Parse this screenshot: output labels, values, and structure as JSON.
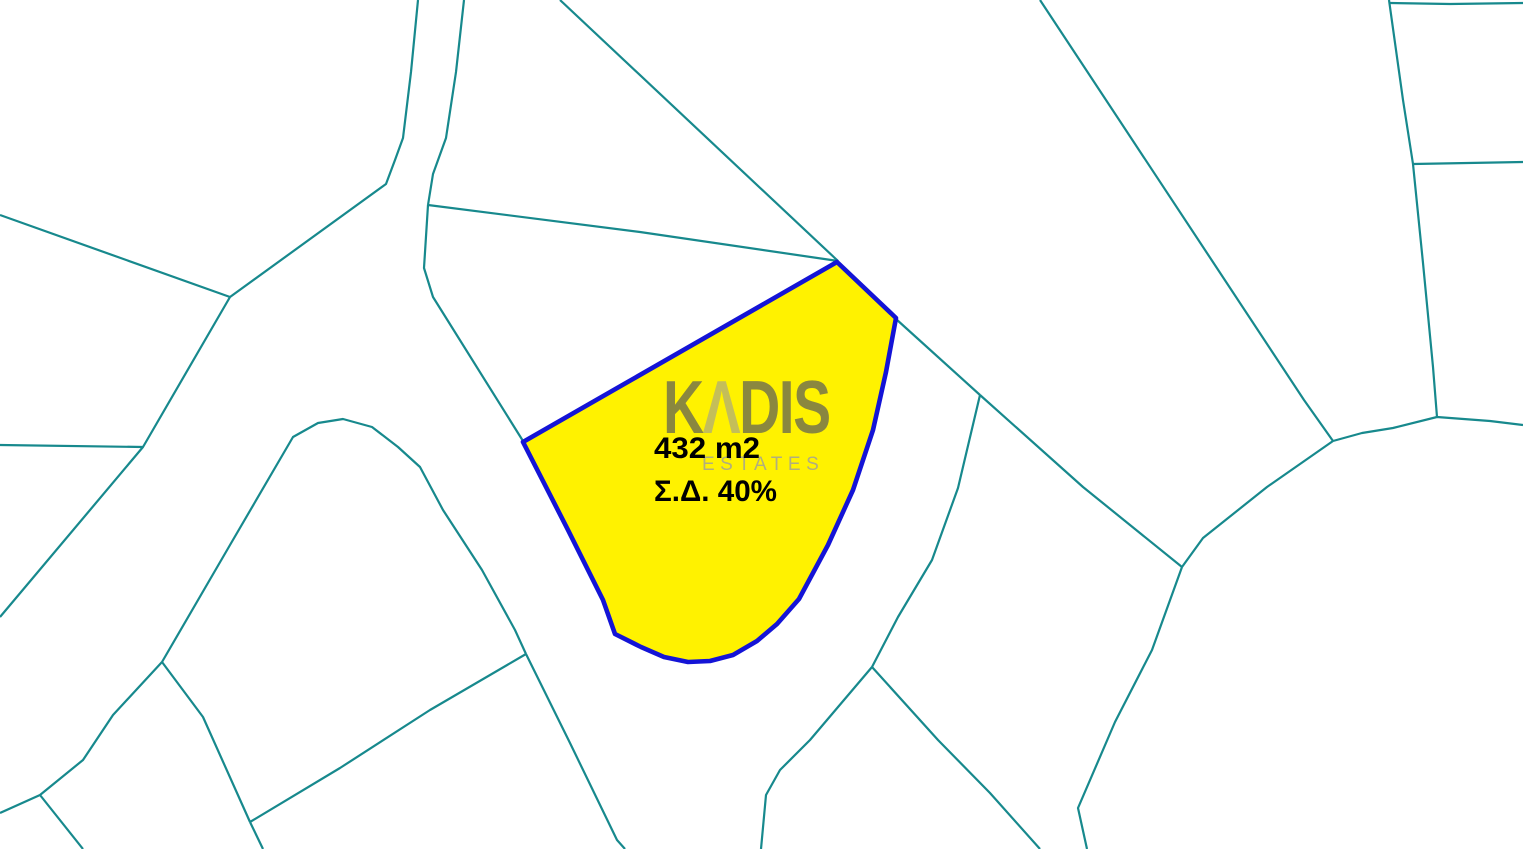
{
  "map": {
    "colors": {
      "background": "#ffffff",
      "boundary": "#17898D",
      "parcel_fill": "#FFF200",
      "parcel_stroke": "#1414D6",
      "label_text": "#000000",
      "watermark_dark": "#5a5a5a",
      "watermark_light": "#9a9a9a",
      "watermark_sub": "#9e9e9e"
    },
    "highlighted_parcel": {
      "area_label": "432 m2",
      "density_label": "Σ.Δ. 40%",
      "outline": [
        [
          523,
          442
        ],
        [
          837,
          262
        ],
        [
          896,
          318
        ],
        [
          886,
          372
        ],
        [
          873,
          430
        ],
        [
          853,
          490
        ],
        [
          828,
          545
        ],
        [
          799,
          599
        ],
        [
          777,
          624
        ],
        [
          757,
          641
        ],
        [
          733,
          655
        ],
        [
          710,
          661
        ],
        [
          688,
          662
        ],
        [
          664,
          657
        ],
        [
          641,
          647
        ],
        [
          615,
          634
        ],
        [
          603,
          600
        ],
        [
          588,
          570
        ],
        [
          568,
          530
        ],
        [
          545,
          485
        ]
      ]
    },
    "watermark": {
      "brand_full": "KADIS",
      "brand_k": "K",
      "brand_a": "Λ",
      "brand_rest": "DIS",
      "subtitle": "ESTATES"
    },
    "boundary_lines": [
      {
        "name": "nw-curve-1",
        "points": [
          [
            418,
            0
          ],
          [
            411,
            72
          ],
          [
            403,
            138
          ],
          [
            395,
            160
          ],
          [
            386,
            184
          ],
          [
            230,
            297
          ]
        ]
      },
      {
        "name": "west-upper",
        "points": [
          [
            230,
            297
          ],
          [
            0,
            215
          ]
        ]
      },
      {
        "name": "west-diagonal",
        "points": [
          [
            230,
            297
          ],
          [
            143,
            447
          ],
          [
            0,
            617
          ]
        ]
      },
      {
        "name": "west-horizontal",
        "points": [
          [
            0,
            445
          ],
          [
            143,
            447
          ]
        ]
      },
      {
        "name": "nw-curve-2",
        "points": [
          [
            464,
            0
          ],
          [
            456,
            72
          ],
          [
            446,
            138
          ],
          [
            433,
            174
          ],
          [
            428,
            205
          ]
        ]
      },
      {
        "name": "above-parcel",
        "points": [
          [
            428,
            205
          ],
          [
            640,
            232
          ],
          [
            838,
            261
          ]
        ]
      },
      {
        "name": "to-parcel-west",
        "points": [
          [
            428,
            205
          ],
          [
            424,
            268
          ],
          [
            433,
            297
          ],
          [
            523,
            441
          ]
        ]
      },
      {
        "name": "north-diagonal",
        "points": [
          [
            560,
            0
          ],
          [
            838,
            261
          ]
        ]
      },
      {
        "name": "parcel-east-link",
        "points": [
          [
            896,
            319
          ],
          [
            980,
            395
          ]
        ]
      },
      {
        "name": "east-diagonal-a",
        "points": [
          [
            980,
            395
          ],
          [
            1083,
            487
          ],
          [
            1182,
            567
          ]
        ]
      },
      {
        "name": "center-south-link",
        "points": [
          [
            980,
            395
          ],
          [
            958,
            488
          ],
          [
            932,
            560
          ],
          [
            898,
            617
          ],
          [
            872,
            667
          ]
        ]
      },
      {
        "name": "long-ne-diagonal",
        "points": [
          [
            1040,
            0
          ],
          [
            1304,
            400
          ],
          [
            1333,
            441
          ]
        ]
      },
      {
        "name": "big-parcel-top",
        "points": [
          [
            1333,
            441
          ],
          [
            1362,
            433
          ],
          [
            1393,
            428
          ],
          [
            1437,
            417
          ],
          [
            1490,
            421
          ],
          [
            1523,
            425
          ]
        ]
      },
      {
        "name": "j2-to-j3",
        "points": [
          [
            1182,
            567
          ],
          [
            1203,
            538
          ],
          [
            1267,
            487
          ],
          [
            1333,
            441
          ]
        ]
      },
      {
        "name": "j2-south",
        "points": [
          [
            1182,
            567
          ],
          [
            1152,
            650
          ],
          [
            1115,
            722
          ],
          [
            1078,
            808
          ],
          [
            1087,
            849
          ]
        ]
      },
      {
        "name": "ne-vertical",
        "points": [
          [
            1389,
            0
          ],
          [
            1403,
            100
          ],
          [
            1413,
            164
          ],
          [
            1423,
            263
          ],
          [
            1433,
            367
          ],
          [
            1437,
            417
          ]
        ]
      },
      {
        "name": "ne-horizontal-top",
        "points": [
          [
            1390,
            3
          ],
          [
            1450,
            4
          ],
          [
            1523,
            3
          ]
        ]
      },
      {
        "name": "ne-horizontal-2",
        "points": [
          [
            1413,
            164
          ],
          [
            1523,
            162
          ]
        ]
      },
      {
        "name": "round-hill-parcel",
        "points": [
          [
            162,
            662
          ],
          [
            230,
            545
          ],
          [
            293,
            437
          ],
          [
            318,
            423
          ],
          [
            343,
            419
          ],
          [
            372,
            427
          ],
          [
            398,
            447
          ],
          [
            420,
            467
          ],
          [
            443,
            510
          ],
          [
            482,
            570
          ],
          [
            515,
            630
          ],
          [
            526,
            654
          ]
        ]
      },
      {
        "name": "south-steep",
        "points": [
          [
            526,
            654
          ],
          [
            570,
            743
          ],
          [
            617,
            840
          ],
          [
            625,
            849
          ]
        ]
      },
      {
        "name": "south-cross",
        "points": [
          [
            526,
            654
          ],
          [
            430,
            710
          ],
          [
            340,
            768
          ],
          [
            250,
            822
          ]
        ]
      },
      {
        "name": "south-cross-tail",
        "points": [
          [
            250,
            822
          ],
          [
            263,
            849
          ]
        ]
      },
      {
        "name": "sw-branch",
        "points": [
          [
            162,
            662
          ],
          [
            203,
            717
          ],
          [
            250,
            822
          ]
        ]
      },
      {
        "name": "sw-curve",
        "points": [
          [
            162,
            662
          ],
          [
            113,
            715
          ],
          [
            83,
            760
          ],
          [
            40,
            795
          ],
          [
            0,
            813
          ]
        ]
      },
      {
        "name": "sw-tail",
        "points": [
          [
            40,
            795
          ],
          [
            83,
            849
          ]
        ]
      },
      {
        "name": "south-center-left",
        "points": [
          [
            872,
            667
          ],
          [
            810,
            740
          ],
          [
            780,
            770
          ],
          [
            766,
            795
          ],
          [
            761,
            849
          ]
        ]
      },
      {
        "name": "south-center-right",
        "points": [
          [
            872,
            667
          ],
          [
            938,
            740
          ],
          [
            990,
            793
          ],
          [
            1040,
            849
          ]
        ]
      }
    ]
  }
}
